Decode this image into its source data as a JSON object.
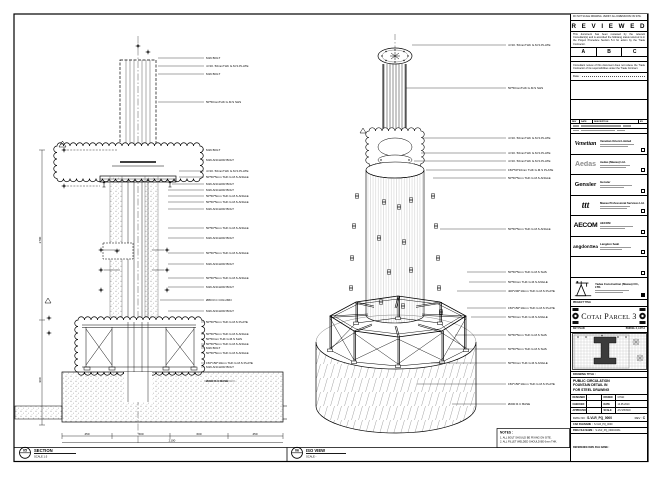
{
  "top_note": "DO NOT SCALE DRAWING. VERIFY ALL DIMENSIONS ON SITE.",
  "reviewed": {
    "title": "R E V I E W E D",
    "body1": "This document has been reviewed by the relevant Consultant(s) and is accorded the following status referred to in the Project Procedure Section 5.4 for action by the Trade Contractor.",
    "cols": [
      "A",
      "B",
      "C"
    ],
    "body2": "Consultant review of this document does not relieve the Trade Contractor of its responsibilities under the Trade Contract.",
    "date_label": "Date :"
  },
  "rev_table": {
    "headers": [
      "REV",
      "DATE",
      "DESCRIPTION",
      "BY"
    ]
  },
  "companies": [
    {
      "logo": "Venetian",
      "name": "Venetian Orient Limited"
    },
    {
      "logo": "Aedas",
      "name": "Aedas (Macau) Ltd."
    },
    {
      "logo": "Gensler",
      "name": "Gensler"
    },
    {
      "logo": "ttt",
      "name": "Macau Professional Services Ltd."
    },
    {
      "logo": "AECOM",
      "name": "AECOM"
    },
    {
      "logo": "LangdonSeah",
      "name": "Langdon Seah"
    }
  ],
  "contractor": {
    "name": "Yadea Construction (Macau) CO., LTD."
  },
  "project": {
    "label": "PROJECT TITLE",
    "title": "Cotai Parcel 3"
  },
  "key_plan": {
    "label": "KEY PLAN",
    "sublabel": "PARCEL 3, LOT A"
  },
  "drawing_block": {
    "label": "DRAWING TITLE :",
    "lines": [
      "PUBLIC CIRCULATION",
      "FOUNTAIN DETAIL IN",
      "FOR STEEL DRAWING"
    ],
    "designed_label": "DESIGNED",
    "designed": "-",
    "drawn_label": "DRAWN",
    "drawn": "CHAN",
    "checked_label": "CHECKED",
    "checked": "-",
    "date_label": "DATE",
    "date": "14.05.2010",
    "approved_label": "APPROVED",
    "approved": "-",
    "scale_label": "SCALE",
    "scale": "AS SHOWN",
    "dwg_label": "DWG NO :",
    "dwg_no": "S-VLR_PQ_0000",
    "rev_label": "REV :",
    "rev": "C",
    "cad_label": "CAD FILENAME :",
    "cad": "S-VLR_PQ_0000",
    "file_label": "DWG FILE NAME :",
    "file": "S-VLR_PQ_0000.DWG",
    "ref_label": "REFERENCE DWG FILE NAME :"
  },
  "views": {
    "section": {
      "num": "05",
      "title": "SECTION",
      "scale": "SCALE 1:5"
    },
    "iso": {
      "num": "06",
      "title": "ISO VIEW",
      "scale": "SCALE  -"
    }
  },
  "notes": {
    "title": "NOTES :",
    "items": [
      "1. ALL BOLT SHOULD BE FIXING ON SITE.",
      "2. ALL FILLET WELDED SHOULD BE 6mm THK."
    ]
  },
  "deltas": {
    "flag": "1"
  },
  "dims": {
    "bottom": [
      "450",
      "600",
      "600",
      "450"
    ],
    "bottom_total": "2100",
    "left_upper": "2700",
    "left_lower": "900"
  },
  "section_callouts": [
    "M16 BOLT",
    "4 NO. 50mmTHK G.M.S PLATE",
    "M16 BOLT",
    "50*50mmTHK G.M.S SHS",
    "M16 BOLT",
    "M16 ANCHOR BOLT",
    "4 NO. 50mmTHK G.M.S PLATE",
    "50*50*5mm THK G.M.S ANGLE",
    "M16 ANCHOR BOLT",
    "M16 ANCHOR BOLT",
    "50*50*5mm THK G.M.S ANGLE",
    "50*50*5mm THK G.M.S ANGLE",
    "M16 ANCHOR BOLT",
    "50*50*5mm THK G.M.S ANGLE",
    "M16 ANCHOR BOLT",
    "50*50*5mm THK G.M.S ANGLE",
    "M16 ANCHOR BOLT",
    "50*50*5mm THK G.M.S ANGLE",
    "M16 ANCHOR BOLT",
    "Ø80 R.C COLUMN",
    "M16 ANCHOR BOLT",
    "50*50*5mm THK G.M.S PLATE",
    "50*50*5mm THK G.M.S ANGLE",
    "50*50mm THK G.M.S SHS",
    "50*50*5mm THK G.M.S ANGLE",
    "M16 BOLT",
    "50*50*5mm THK G.M.S ANGLE",
    "150*150*10mm THK G.M.S PLATE",
    "M16 ANCHOR BOLT",
    "Ø200 R.C BASE"
  ],
  "iso_callouts": [
    "4 NO. 50mmTHK G.M.S PLATE",
    "50*50mmTHK G.M.S SHS",
    "4 NO. 50mmTHK G.M.S PLATE",
    "4 NO. 50mmTHK G.M.S PLATE",
    "4 NO. 50mmTHK G.M.S PLATE",
    "150*50*10mm THK G.M.S PLATE",
    "50*50*5mm THK G.M.S ANGLE",
    "50*50*5mm THK G.M.S ANGLE",
    "50*50*5mm THK G.M.S SHS",
    "50*50mm THK G.M.S ANGLE",
    "400*200*10mm THK G.M.S PLATE",
    "150*150*10mm THK G.M.S PLATE",
    "50*50mm THK G.M.S ANGLE",
    "50*50*5mm THK G.M.S SHS",
    "50*50*5mm THK G.M.S SHS",
    "50*50mm THK G.M.S ANGLE",
    "150*150*10mm THK G.M.S PLATE",
    "Ø200 R.C BASE"
  ]
}
